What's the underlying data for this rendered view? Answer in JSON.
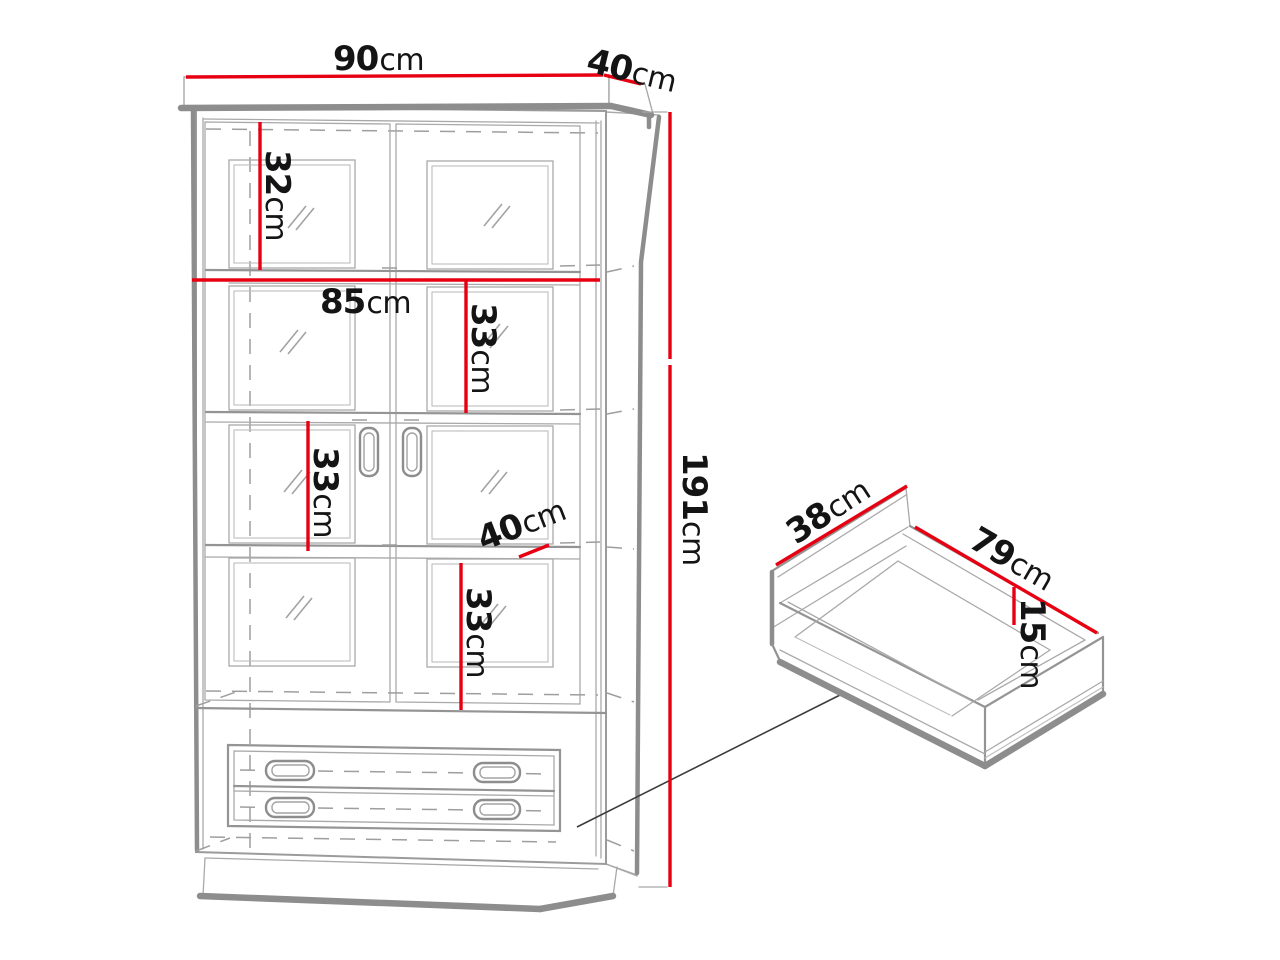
{
  "diagram": {
    "kind": "furniture-dimension-diagram",
    "subject": "Two-door glass display cabinet with two drawers, plus detail view of a pulled-out drawer",
    "colors": {
      "dimension_line": "#e60012",
      "drawing_line": "#8d8d8d",
      "text": "#141414",
      "background": "#ffffff"
    },
    "cabinet_view": {
      "name": "cabinet-front-view",
      "dimensions": [
        {
          "id": "cabinet-width",
          "value": "90",
          "unit": "cm"
        },
        {
          "id": "cabinet-depth",
          "value": "40",
          "unit": "cm"
        },
        {
          "id": "top-section-height",
          "value": "32",
          "unit": "cm"
        },
        {
          "id": "interior-width",
          "value": "85",
          "unit": "cm"
        },
        {
          "id": "upper-shelf-spacing",
          "value": "33",
          "unit": "cm"
        },
        {
          "id": "middle-shelf-spacing",
          "value": "33",
          "unit": "cm"
        },
        {
          "id": "shelf-depth",
          "value": "40",
          "unit": "cm"
        },
        {
          "id": "lower-shelf-spacing",
          "value": "33",
          "unit": "cm"
        },
        {
          "id": "cabinet-height",
          "value": "191",
          "unit": "cm"
        }
      ]
    },
    "drawer_view": {
      "name": "drawer-detail-view",
      "dimensions": [
        {
          "id": "drawer-depth",
          "value": "38",
          "unit": "cm"
        },
        {
          "id": "drawer-width",
          "value": "79",
          "unit": "cm"
        },
        {
          "id": "drawer-height",
          "value": "15",
          "unit": "cm"
        }
      ]
    }
  }
}
